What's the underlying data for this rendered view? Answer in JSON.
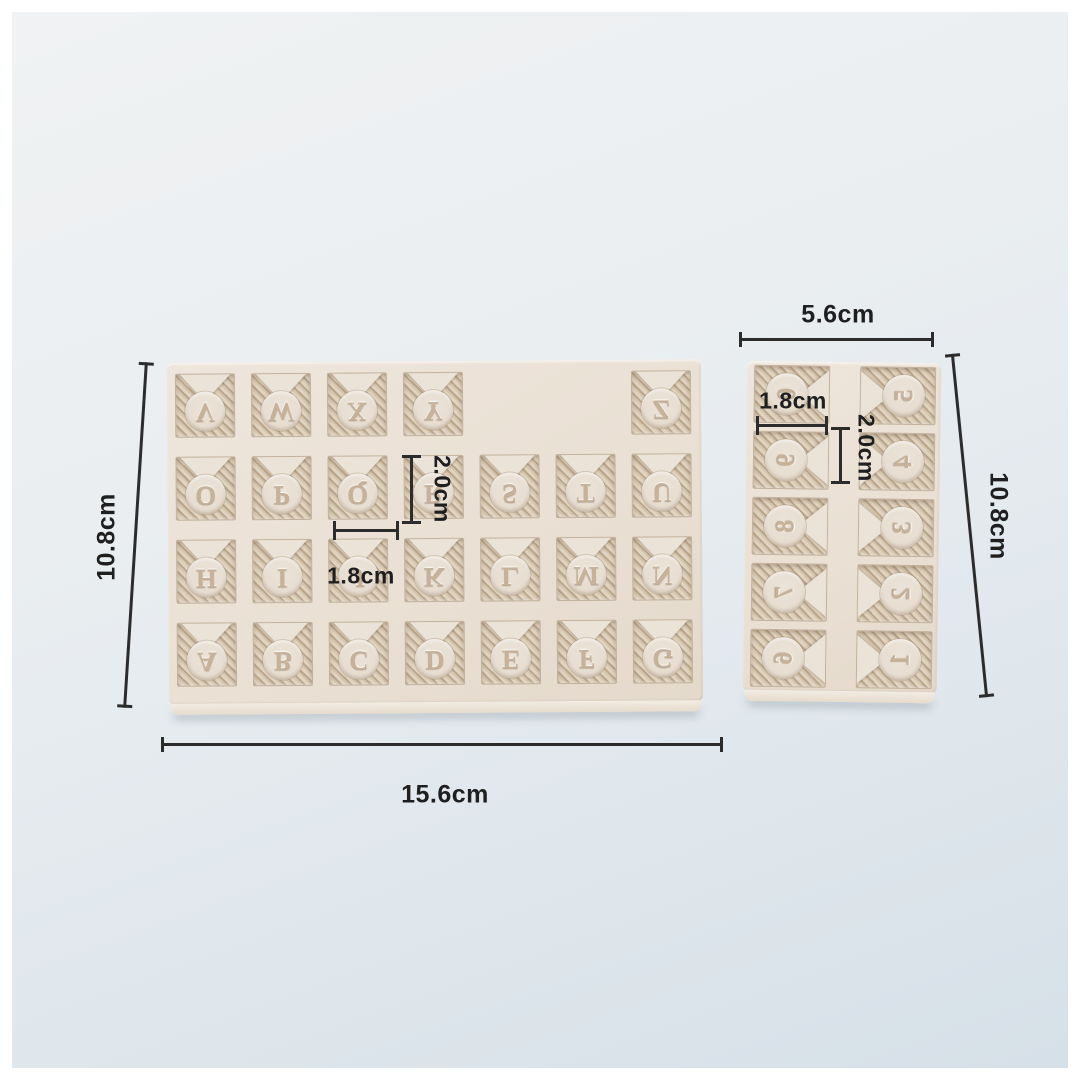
{
  "large_mold": {
    "rows": [
      [
        "V",
        "W",
        "X",
        "Y",
        "",
        "",
        "Z"
      ],
      [
        "O",
        "P",
        "Q",
        "R",
        "S",
        "T",
        "U"
      ],
      [
        "H",
        "I",
        "J",
        "K",
        "L",
        "M",
        "N"
      ],
      [
        "A",
        "B",
        "C",
        "D",
        "E",
        "F",
        "G"
      ]
    ],
    "dim_width": "15.6cm",
    "dim_height": "10.8cm",
    "dim_cell_width": "1.8cm",
    "dim_cell_height": "2.0cm"
  },
  "small_mold": {
    "columns": [
      [
        "0",
        "9",
        "8",
        "7",
        "6"
      ],
      [
        "5",
        "4",
        "3",
        "2",
        "1"
      ]
    ],
    "dim_width": "5.6cm",
    "dim_height": "10.8cm",
    "dim_cell_width": "1.8cm",
    "dim_cell_height": "2.0cm"
  },
  "colors": {
    "mold_body": "#ece3d8",
    "hatch_stripe": "#b9a68c",
    "hatch_base": "#ddd0bd",
    "disc": "#e8ded2",
    "glyph": "#c6b29a",
    "background_top": "#f0f2f3",
    "background_bottom": "#d6e0e8",
    "dimension": "#2c2c2c"
  }
}
